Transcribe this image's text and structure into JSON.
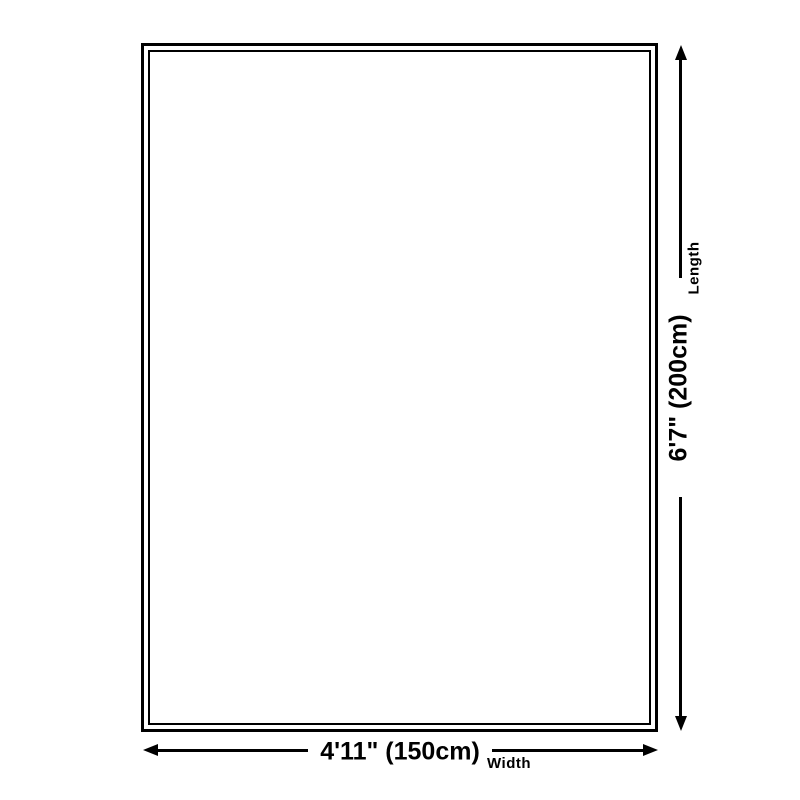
{
  "diagram": {
    "type": "product-size-diagram",
    "length": {
      "value": "6'7\" (200cm)",
      "label": "Length"
    },
    "width": {
      "value": "4'11\" (150cm)",
      "label": "Width"
    }
  },
  "colors": {
    "line": "#000000",
    "background": "#ffffff"
  }
}
